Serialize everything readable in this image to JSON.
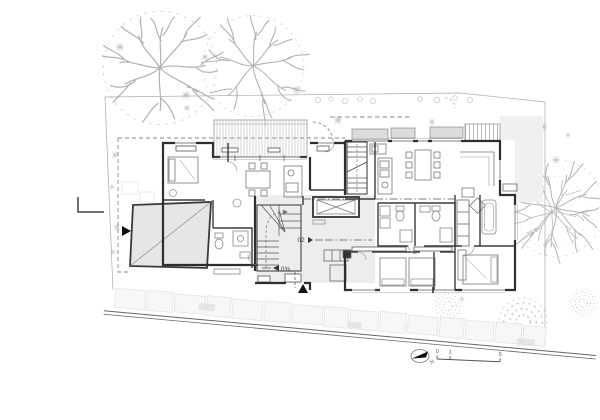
{
  "plan": {
    "level_marker": "02",
    "slope_marker": "0%",
    "north_letter": "N",
    "scale_bar": {
      "tick0": "0",
      "tick1": "1",
      "tick2": "5"
    }
  },
  "colors": {
    "wall": "#333333",
    "garage_fill": "#e6e6e6",
    "hall_fill": "#ededed",
    "planter_fill": "#dcdcdc",
    "terrace_fill": "#f0f0f0",
    "vegetation": "#b2b2b2",
    "paving": "#f7f7f7"
  }
}
